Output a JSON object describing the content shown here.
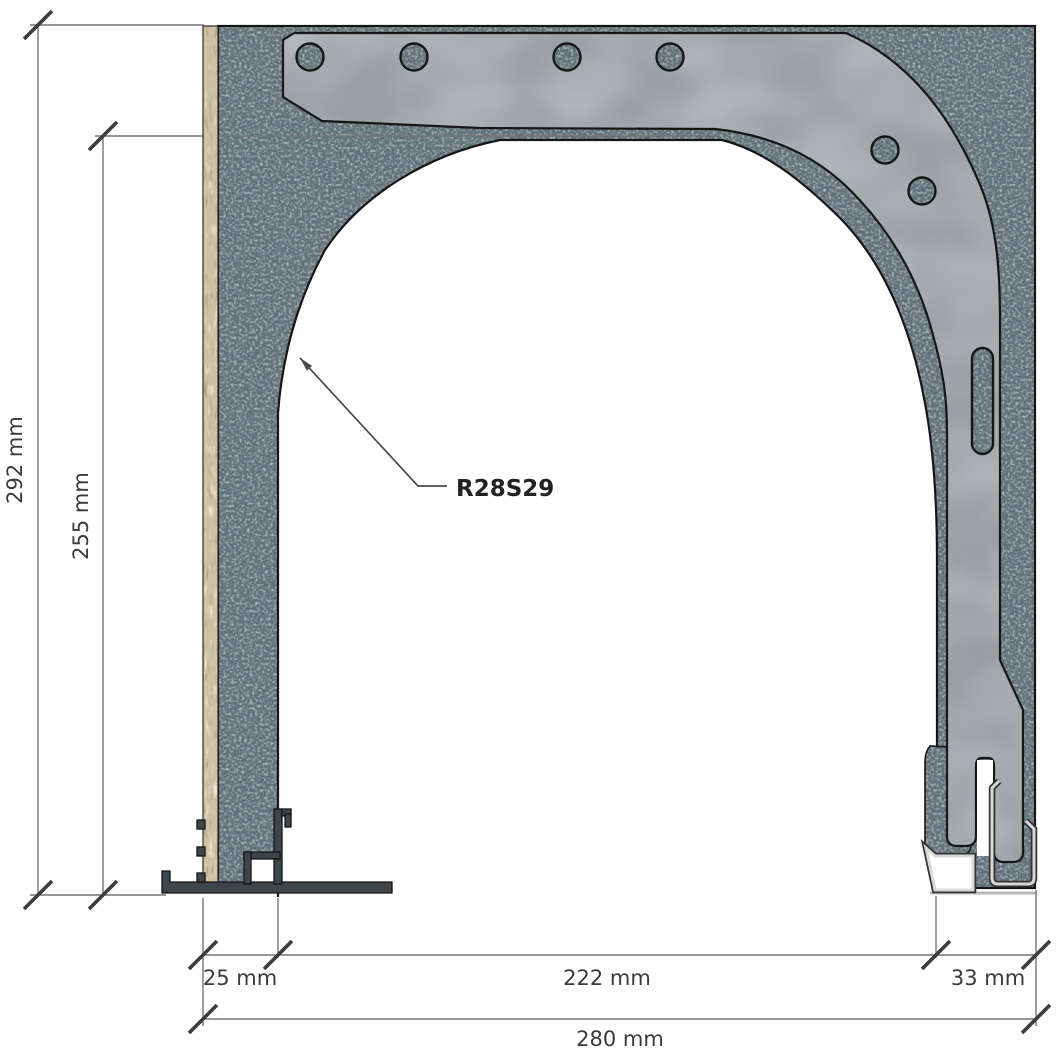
{
  "drawing": {
    "part_label": "R28S29",
    "dimensions": {
      "outer_height": "292 mm",
      "inner_height": "255 mm",
      "left_wall": "25 mm",
      "opening_width": "222 mm",
      "right_assembly": "33 mm",
      "total_width": "280 mm"
    },
    "colors": {
      "insulation_fill": "#64727a",
      "bracket_fill": "#9ba2a6",
      "wood_fill": "#cfc2a4",
      "aluminum_fill": "#e8e8e6",
      "track_fill": "#3e464b",
      "outline": "#161616",
      "dimension_line": "#757575",
      "dimension_text": "#3a3a3a",
      "leader_text": "#222222",
      "background": "#ffffff"
    }
  }
}
